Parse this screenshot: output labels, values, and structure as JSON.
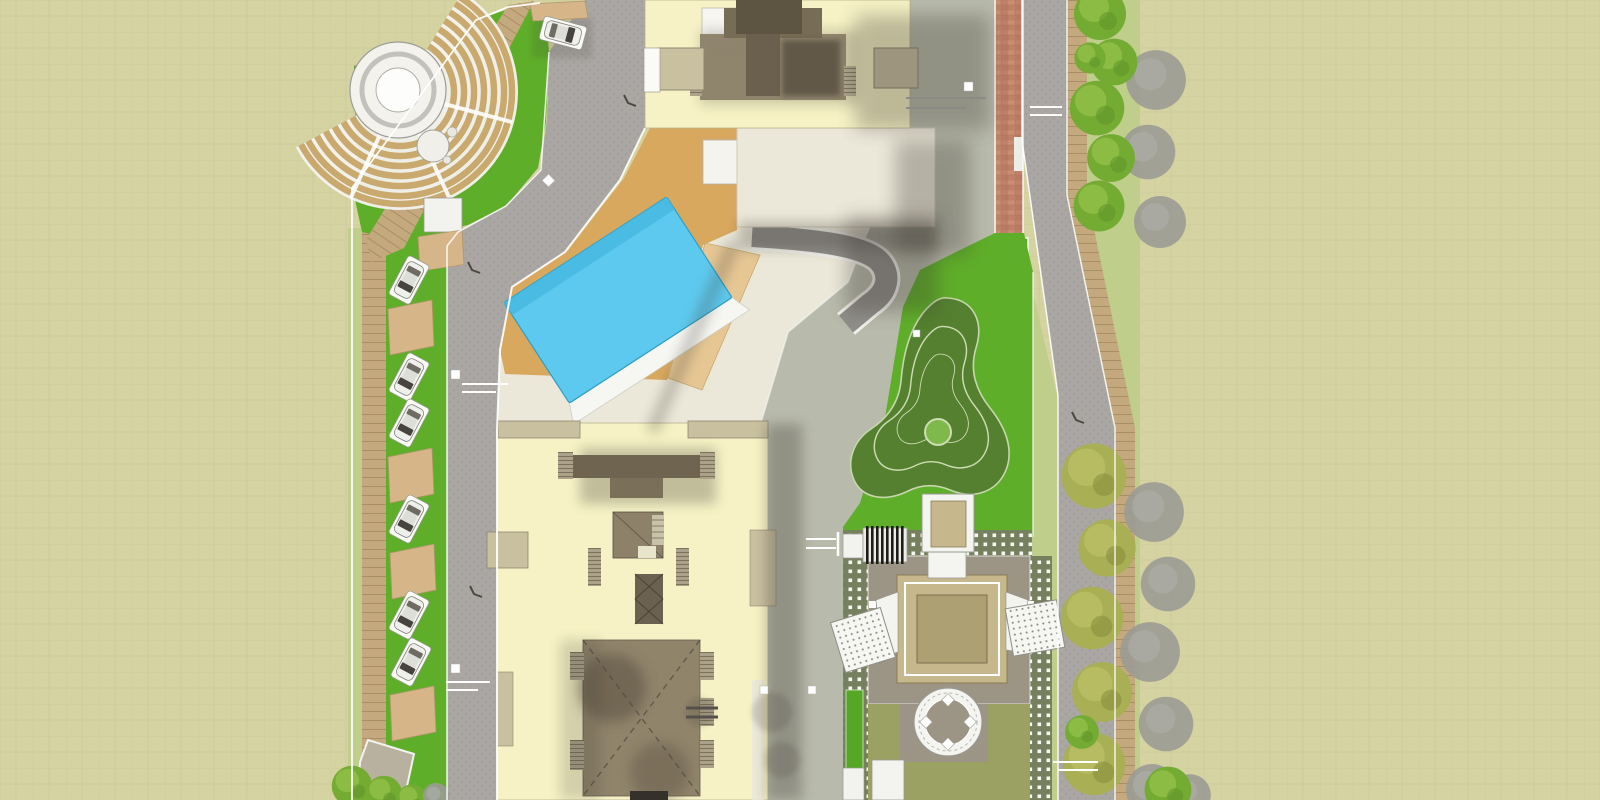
{
  "scene": {
    "kind": "architectural master site plan, top-down color rendering",
    "canvas": {
      "width": 1600,
      "height": 800
    },
    "no_visible_text": true
  },
  "palette": {
    "bg": "#D6D3A2",
    "bgLine": "#C8C593",
    "lawn": "#5FAE2A",
    "lawnDark": "#47971F",
    "lawnPale": "#BFCE8B",
    "lawnOlive": "#9BA163",
    "road": "#A9A6A3",
    "drive": "#B8BAAB",
    "ramp": "#908E89",
    "brick": "#C08169",
    "board": "#C4A97E",
    "plank": "#A78E63",
    "seat": "#C9A96D",
    "stage": "#F3F2ED",
    "pool": "#5EC9EE",
    "poolEdge": "#2E9EC4",
    "deck": "#D8A85E",
    "deckLight": "#E6C794",
    "cream": "#EBE8D9",
    "tower": "#F6F2C5",
    "tab": "#C9C0A0",
    "tabEdge": "#8F8670",
    "coreTaupe": "#8D8169",
    "coreDark": "#5E5442",
    "coreMid": "#776C55",
    "plaza": "#9C9484",
    "pavilion": "#C6B78C",
    "pavilionInner": "#ADA072",
    "mound": "#54802F",
    "moundLine": "#CDDCB4",
    "hedge": "#55A826",
    "paver": "#76805F",
    "treeGreen": "#74AC33",
    "treeHi": "#9CC74F",
    "treeOlive": "#A9AF54",
    "treeGray": "#9B9B95",
    "car": "#EFEFEC",
    "shadow": "#3A362E",
    "curb": "#FFFFFF"
  },
  "features": {
    "amphitheater": {
      "seat_rows": 7,
      "stage_circles": 3
    },
    "swimming_pool": {
      "shape": "rotated rectangle",
      "white_edge_band": true
    },
    "towers": {
      "count": 2
    },
    "parking": {
      "cars_in_left_row": 6,
      "cars_at_entry": 1,
      "canopies": 6
    },
    "central_plaza": {
      "main_pavilion": 1,
      "small_pavilion": 1,
      "trellis_ramps": 2,
      "seating_circle_seats": 4,
      "pergola_slats": 8
    },
    "mound_garden": {
      "lobes": 3,
      "contour_rings": 2,
      "center_circle": 1
    },
    "trees": {
      "green_row_top": 6,
      "olive_row_bottom": 5,
      "gray_shadow_trees": 10,
      "corner_cluster": 3
    },
    "paths": [
      "red-brick-path",
      "left-boardwalk",
      "right-boardwalk",
      "diagonal-boardwalk",
      "paver-bands"
    ],
    "roads": [
      "west-internal-road",
      "east-drive",
      "right-perimeter-road",
      "podium-ramp"
    ]
  }
}
